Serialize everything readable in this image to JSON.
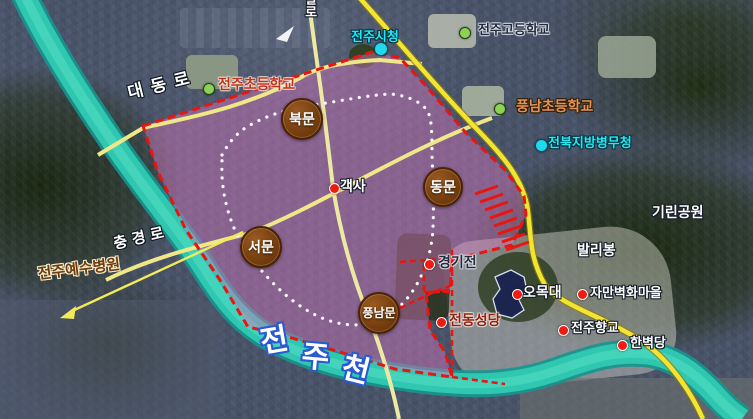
{
  "map": {
    "labels": [
      {
        "id": "jeonju-city-hall",
        "text": "전주시청",
        "x": 351,
        "y": 30,
        "size": 13,
        "style": "cyan",
        "dot": {
          "x": 380,
          "y": 48,
          "type": "cyan",
          "r": 6
        }
      },
      {
        "id": "jeonju-high-school",
        "text": "전주고등학교",
        "x": 478,
        "y": 23,
        "size": 13,
        "style": "navy",
        "dot": {
          "x": 464,
          "y": 32,
          "type": "green",
          "r": 5
        }
      },
      {
        "id": "jeonju-elementary-school",
        "text": "전주초등학교",
        "x": 218,
        "y": 77,
        "size": 14,
        "style": "red-label",
        "dot": {
          "x": 208,
          "y": 88,
          "type": "green",
          "r": 5
        }
      },
      {
        "id": "pungnam-elementary-school",
        "text": "풍남초등학교",
        "x": 516,
        "y": 99,
        "size": 14,
        "style": "orange",
        "dot": {
          "x": 499,
          "y": 108,
          "type": "green",
          "r": 5
        }
      },
      {
        "id": "jeonbuk-military-manpower-office",
        "text": "전북지방병무청",
        "x": 548,
        "y": 136,
        "size": 13,
        "style": "cyan",
        "dot": {
          "x": 540,
          "y": 144,
          "type": "cyan",
          "r": 5.5
        }
      },
      {
        "id": "girin-park",
        "text": "기린공원",
        "x": 652,
        "y": 205,
        "size": 14,
        "style": "white"
      },
      {
        "id": "balibong",
        "text": "발리봉",
        "x": 577,
        "y": 243,
        "size": 14,
        "style": "white"
      },
      {
        "id": "gaeksa",
        "text": "객사",
        "x": 340,
        "y": 179,
        "size": 14,
        "style": "white",
        "dot": {
          "x": 333,
          "y": 187,
          "type": "red",
          "r": 4.5
        }
      },
      {
        "id": "gyeonggijeon",
        "text": "경기전",
        "x": 438,
        "y": 255,
        "size": 14,
        "style": "navy",
        "dot": {
          "x": 428,
          "y": 263,
          "type": "red",
          "r": 4.5
        }
      },
      {
        "id": "jeondong-cathedral",
        "text": "전동성당",
        "x": 449,
        "y": 313,
        "size": 14,
        "style": "maroon",
        "dot": {
          "x": 440,
          "y": 321,
          "type": "red",
          "r": 4.5
        }
      },
      {
        "id": "omokdae",
        "text": "오목대",
        "x": 523,
        "y": 285,
        "size": 14,
        "style": "white",
        "dot": {
          "x": 516,
          "y": 293,
          "type": "red",
          "r": 4.5
        }
      },
      {
        "id": "jaman-mural-village",
        "text": "자만벽화마을",
        "x": 590,
        "y": 286,
        "size": 13,
        "style": "white",
        "dot": {
          "x": 581,
          "y": 293,
          "type": "red",
          "r": 4.5
        }
      },
      {
        "id": "jeonju-hyanggyo",
        "text": "전주향교",
        "x": 571,
        "y": 321,
        "size": 13,
        "style": "white",
        "dot": {
          "x": 562,
          "y": 329,
          "type": "red",
          "r": 4.5
        }
      },
      {
        "id": "hanbyeokdang",
        "text": "한벽당",
        "x": 630,
        "y": 336,
        "size": 13,
        "style": "white",
        "dot": {
          "x": 621,
          "y": 344,
          "type": "red",
          "r": 4.5
        }
      },
      {
        "id": "jeonju-jesus-hospital",
        "text": "전주예수병원",
        "x": 37,
        "y": 267,
        "size": 15,
        "style": "brown",
        "rot": -7
      },
      {
        "id": "road-daedong-ro",
        "text": "대동로",
        "x": 126,
        "y": 85,
        "size": 17,
        "style": "road",
        "rot": -14,
        "spacing": 8
      },
      {
        "id": "road-chunggyeong-ro",
        "text": "충경로",
        "x": 112,
        "y": 237,
        "size": 15,
        "style": "road",
        "rot": -13,
        "spacing": 5
      },
      {
        "id": "road-paldal-ro-partial",
        "text": "달로",
        "x": 303,
        "y": -8,
        "size": 13,
        "style": "road",
        "vertical": true
      }
    ],
    "gates": [
      {
        "id": "bukmun-north-gate",
        "text": "북문",
        "x": 302,
        "y": 119,
        "d": 42,
        "fs": 14
      },
      {
        "id": "dongmun-east-gate",
        "text": "동문",
        "x": 443,
        "y": 187,
        "d": 40,
        "fs": 14
      },
      {
        "id": "seomun-west-gate",
        "text": "서문",
        "x": 261,
        "y": 247,
        "d": 42,
        "fs": 14
      },
      {
        "id": "pungnammun-south-gate",
        "text": "풍남문",
        "x": 379,
        "y": 313,
        "d": 42,
        "fs": 12
      }
    ],
    "river_label": {
      "size": 30,
      "style": "river",
      "chars": [
        {
          "ch": "전",
          "x": 258,
          "y": 328,
          "rot": -10
        },
        {
          "ch": "주",
          "x": 303,
          "y": 341,
          "rot": 5
        },
        {
          "ch": "천",
          "x": 346,
          "y": 352,
          "rot": 14
        }
      ]
    }
  },
  "colors": {
    "pink_overlay": "#d678be",
    "boundary_red": "#ea1410",
    "wall_dotted_white": "#ffffff",
    "river_teal": "#2fc7b0",
    "river_edge": "#17958f",
    "road_major_yellow": "#f4e432",
    "road_minor_yellow": "#eee9a2",
    "badge_brown": "#77400f",
    "badge_border": "#4a2205",
    "omokdae_navy": "#1b2450",
    "arrow_yellow": "#f2ea58",
    "label_styles": {
      "white": {
        "fill": "#ffffff",
        "outline": "#141c28",
        "ow": 1
      },
      "cyan": {
        "fill": "#25e8f5",
        "outline": "#05303c",
        "ow": 1
      },
      "navy": {
        "fill": "#222b3a",
        "outline": "rgba(235,240,248,0.5)",
        "ow": 1
      },
      "red-label": {
        "fill": "#c5301c",
        "outline": "rgba(255,246,232,0.45)",
        "ow": 1
      },
      "orange": {
        "fill": "#e79355",
        "outline": "#2e1d08",
        "ow": 1
      },
      "maroon": {
        "fill": "#8e2012",
        "outline": "rgba(255,242,230,0.45)",
        "ow": 1
      },
      "brown": {
        "fill": "#6e3a10",
        "outline": "#f5ecc8",
        "ow": 1
      },
      "road": {
        "fill": "#ffffff",
        "outline": "#101820",
        "ow": 1
      },
      "river": {
        "fill": "#ffffff",
        "outline": "#2b5ad0",
        "ow": 2
      }
    },
    "dot_colors": {
      "red": {
        "fill": "#ee1b12",
        "edge": "#ffffff"
      },
      "green": {
        "fill": "#8ed157",
        "edge": "#23430f"
      },
      "cyan": {
        "fill": "#1fd9ec",
        "edge": "#0b4a5a"
      }
    }
  }
}
